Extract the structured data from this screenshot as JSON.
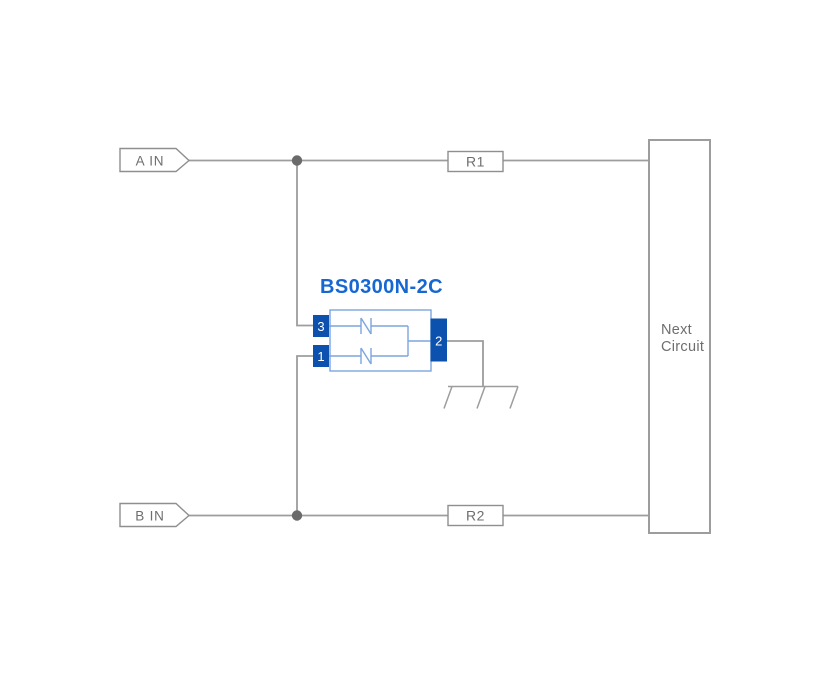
{
  "colors": {
    "background": "#ffffff",
    "wire": "#9d9d9d",
    "box-border": "#8f8f8f",
    "text-gray": "#6e6e6e",
    "junction": "#6a6a6a",
    "body-blue": "#7ba6de",
    "pin-blue": "#0b51ad",
    "label-blue": "#1767d2"
  },
  "diagram": {
    "component": {
      "name": "BS0300N-2C",
      "pins": {
        "top_left": "3",
        "bottom_left": "1",
        "common_right": "2"
      }
    },
    "inputs": {
      "a": "A IN",
      "b": "B IN"
    },
    "resistors": {
      "top": "R1",
      "bottom": "R2"
    },
    "next_circuit": {
      "line1": "Next",
      "line2": "Circuit"
    },
    "icons": {
      "ground": "earth-ground-symbol",
      "junction_a": "wire-junction-dot",
      "junction_b": "wire-junction-dot",
      "diodes": "back-to-back-suppressor-diode-symbol"
    }
  }
}
